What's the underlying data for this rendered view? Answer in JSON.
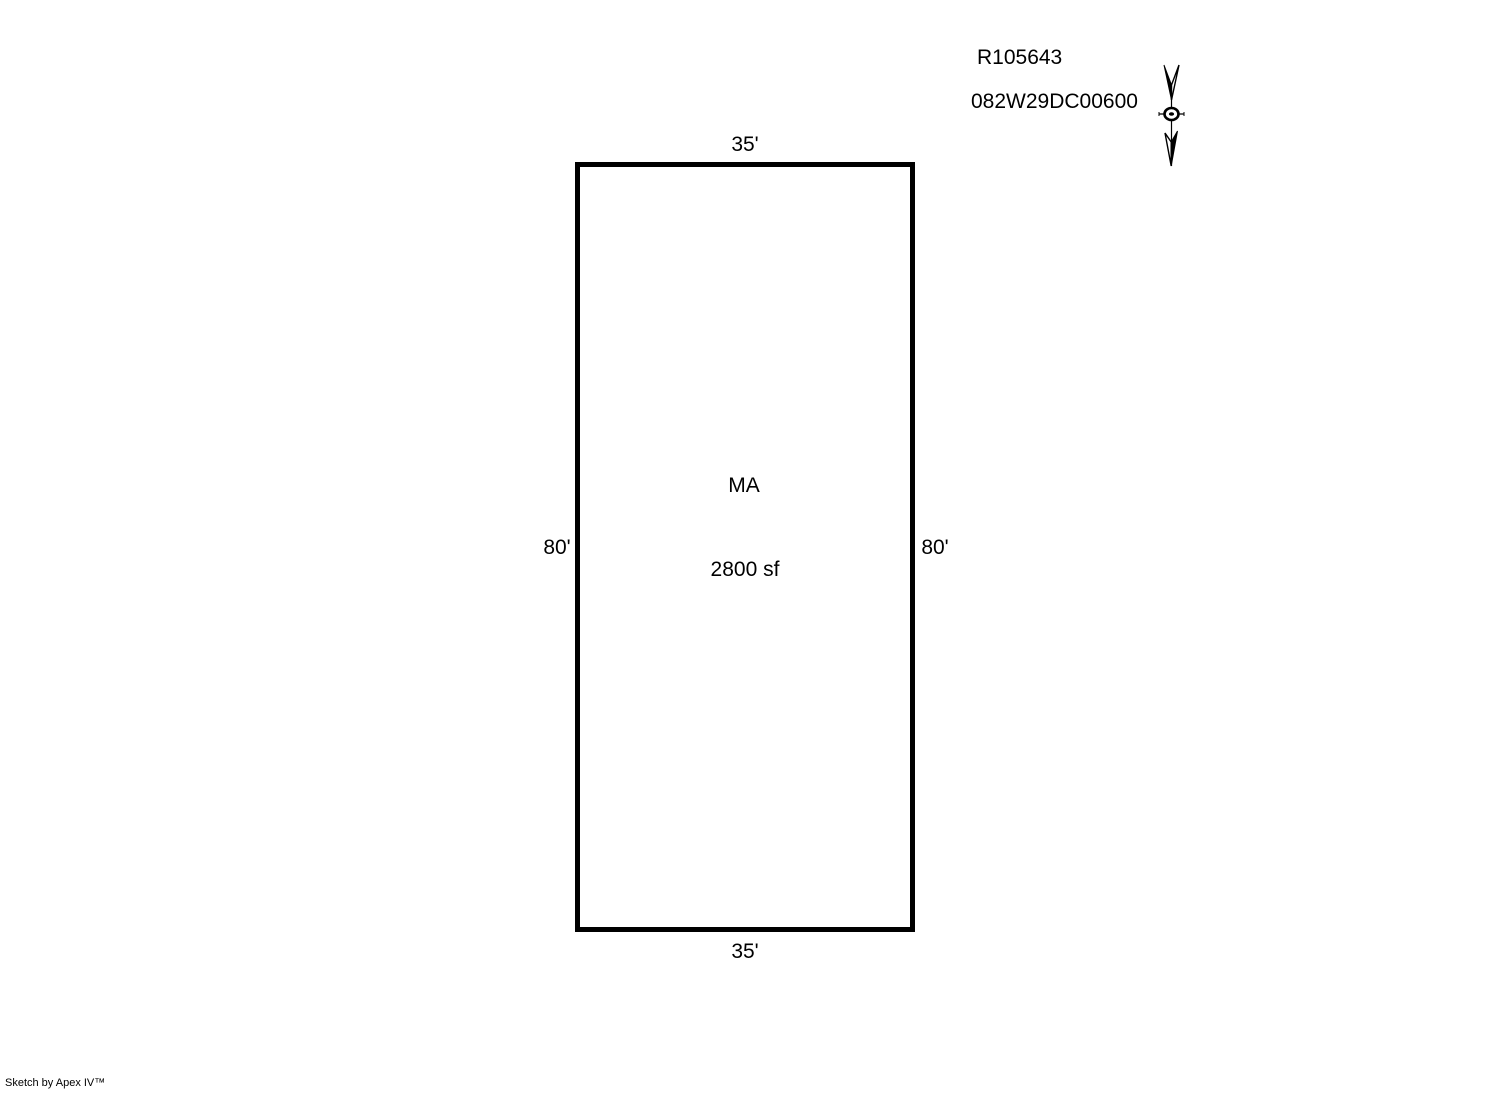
{
  "page": {
    "background_color": "#ffffff",
    "line_color": "#000000",
    "footer_branding": "Sketch by Apex IV™"
  },
  "header": {
    "account_number": "R105643",
    "map_taxlot": "082W29DC00600"
  },
  "north_arrow": {
    "icon": "north-arrow-icon",
    "direction": "down"
  },
  "parcel_sketch": {
    "area_label": "MA",
    "area_size": "2800 sf",
    "dimensions": {
      "top": "35'",
      "bottom": "35'",
      "left": "80'",
      "right": "80'"
    }
  }
}
